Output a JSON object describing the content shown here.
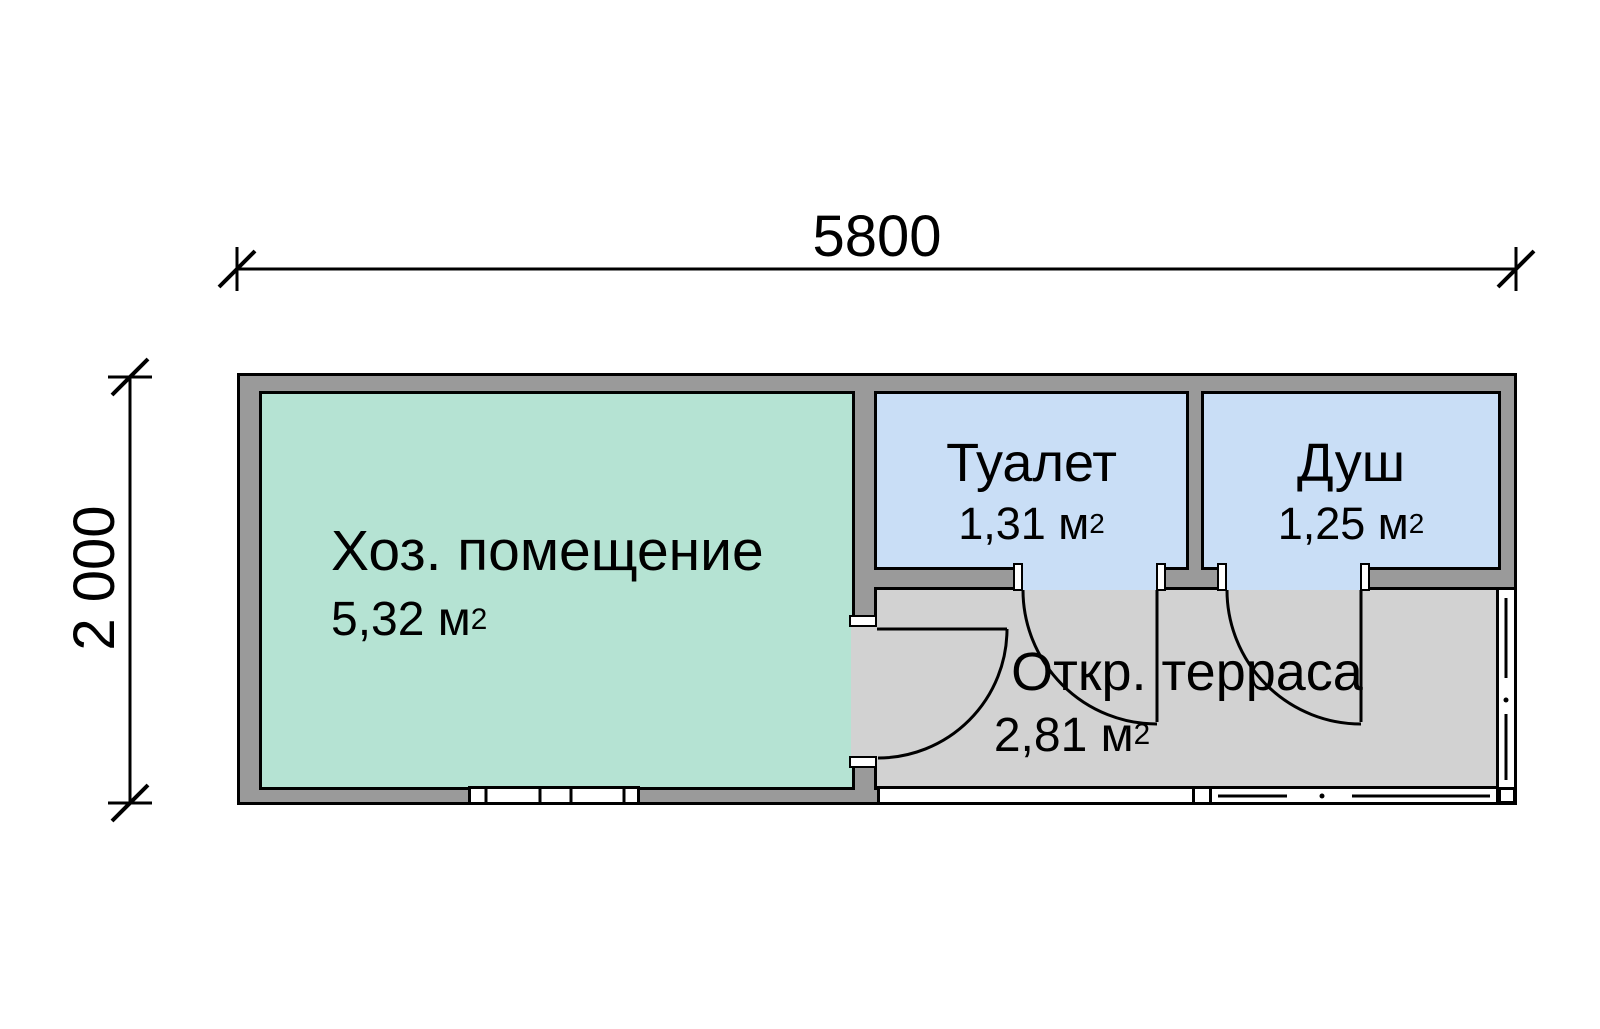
{
  "dimensions": {
    "width_label": "5800",
    "height_label": "2 000"
  },
  "rooms": {
    "utility": {
      "name": "Хоз. помещение",
      "area": "5,32 м",
      "area_sup": "2"
    },
    "toilet": {
      "name": "Туалет",
      "area": "1,31 м",
      "area_sup": "2"
    },
    "shower": {
      "name": "Душ",
      "area": "1,25 м",
      "area_sup": "2"
    },
    "terrace": {
      "name": "Откр. терраса",
      "area": "2,81 м",
      "area_sup": "2"
    }
  },
  "colors": {
    "utility_fill": "#b5e3d3",
    "wet_fill": "#c9def6",
    "terrace_fill": "#d2d2d2",
    "wall_fill": "#9a9a9a",
    "line": "#000000"
  }
}
